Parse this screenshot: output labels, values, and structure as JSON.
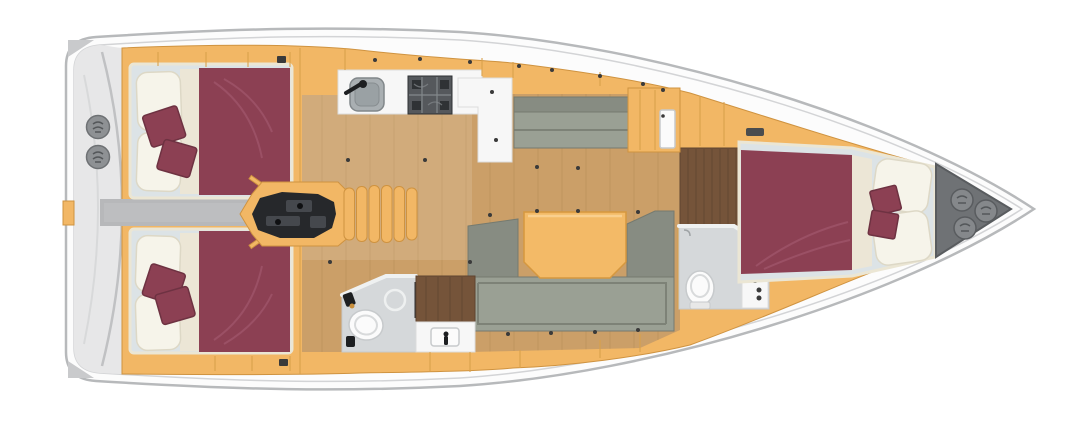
{
  "diagram": {
    "type": "boat-floor-plan",
    "subject": "sailing yacht interior layout, top-down view, bow pointing right",
    "areas": [
      {
        "id": "stern-deck",
        "features": [
          "swim-platform-arc",
          "winch",
          "winch"
        ]
      },
      {
        "id": "aft-cabin-upper",
        "features": [
          "double-berth",
          "pillow",
          "pillow",
          "cushion",
          "cushion",
          "wardrobe"
        ]
      },
      {
        "id": "aft-cabin-lower",
        "features": [
          "double-berth",
          "pillow",
          "pillow",
          "cushion",
          "cushion",
          "wardrobe"
        ]
      },
      {
        "id": "corridor",
        "features": [
          "passage-between-aft-cabins"
        ]
      },
      {
        "id": "companionway",
        "features": [
          "stairs-six-treads",
          "engine-bay"
        ]
      },
      {
        "id": "galley",
        "features": [
          "sink",
          "faucet",
          "two-burner-stove",
          "l-shaped-counter"
        ]
      },
      {
        "id": "salon",
        "features": [
          "settee",
          "u-shaped-sofa",
          "dining-table",
          "oak-plank-floor"
        ]
      },
      {
        "id": "aft-head",
        "features": [
          "toilet",
          "shower-drain",
          "vanity-sink",
          "walnut-panel"
        ]
      },
      {
        "id": "forward-head",
        "features": [
          "toilet",
          "vanity-sink"
        ]
      },
      {
        "id": "forward-cabin",
        "features": [
          "double-berth",
          "pillow",
          "pillow",
          "cushion",
          "cushion",
          "walnut-entry-floor",
          "vent"
        ]
      },
      {
        "id": "bow-locker",
        "features": [
          "deck-hatch",
          "deck-hatch",
          "deck-hatch"
        ]
      }
    ]
  },
  "colors": {
    "hull_fill": "#fcfcfc",
    "hull_stroke": "#b7b9bb",
    "deck_line": "#d3d4d6",
    "stern_deck": "#e7e7e8",
    "stern_arc": "#c0c1c3",
    "wedge": "#c9cacc",
    "wood": "#f2b765",
    "wood_stroke": "#cf9340",
    "wood_seam": "#d9a14b",
    "hardware_dot": "#3a3a3a",
    "oak": "#cb9f68",
    "oak_line": "#b78e56",
    "walnut": "#75543a",
    "walnut_line": "#5f4430",
    "corridor": "#b7b8ba",
    "burgundy": "#8c4053",
    "burgundy_fold": "#9e5468",
    "burgundy_dark": "#6e3242",
    "mattress": "#dce3e6",
    "mattress_edge": "#ebe6d4",
    "pillow": "#f6f4ea",
    "pillow_edge": "#ddd8c6",
    "sheet": "#ece6d6",
    "sofa": "#9aa094",
    "sofa_dark": "#878c82",
    "sofa_line": "#757a6f",
    "table": "#f3ba67",
    "table_stroke": "#d6983f",
    "counter": "#f7f7f7",
    "counter_stroke": "#dcdcdc",
    "sink_steel": "#a9afb2",
    "sink_dark": "#81878a",
    "stove": "#55585c",
    "stove_grid": "#83888c",
    "stove_dark": "#2f3235",
    "head_floor": "#d5d8da",
    "head_wall": "#eff1f1",
    "white_fix": "#fbfbfb",
    "fix_stroke": "#c7cacc",
    "engine": "#26282b",
    "engine_mid": "#45484d",
    "locker": "#6f7275",
    "locker_stroke": "#595c5f",
    "locker_circle": "#85888b",
    "winch": "#8e9194",
    "winch_stroke": "#6e7174",
    "fitting_black": "#1d1f21"
  }
}
